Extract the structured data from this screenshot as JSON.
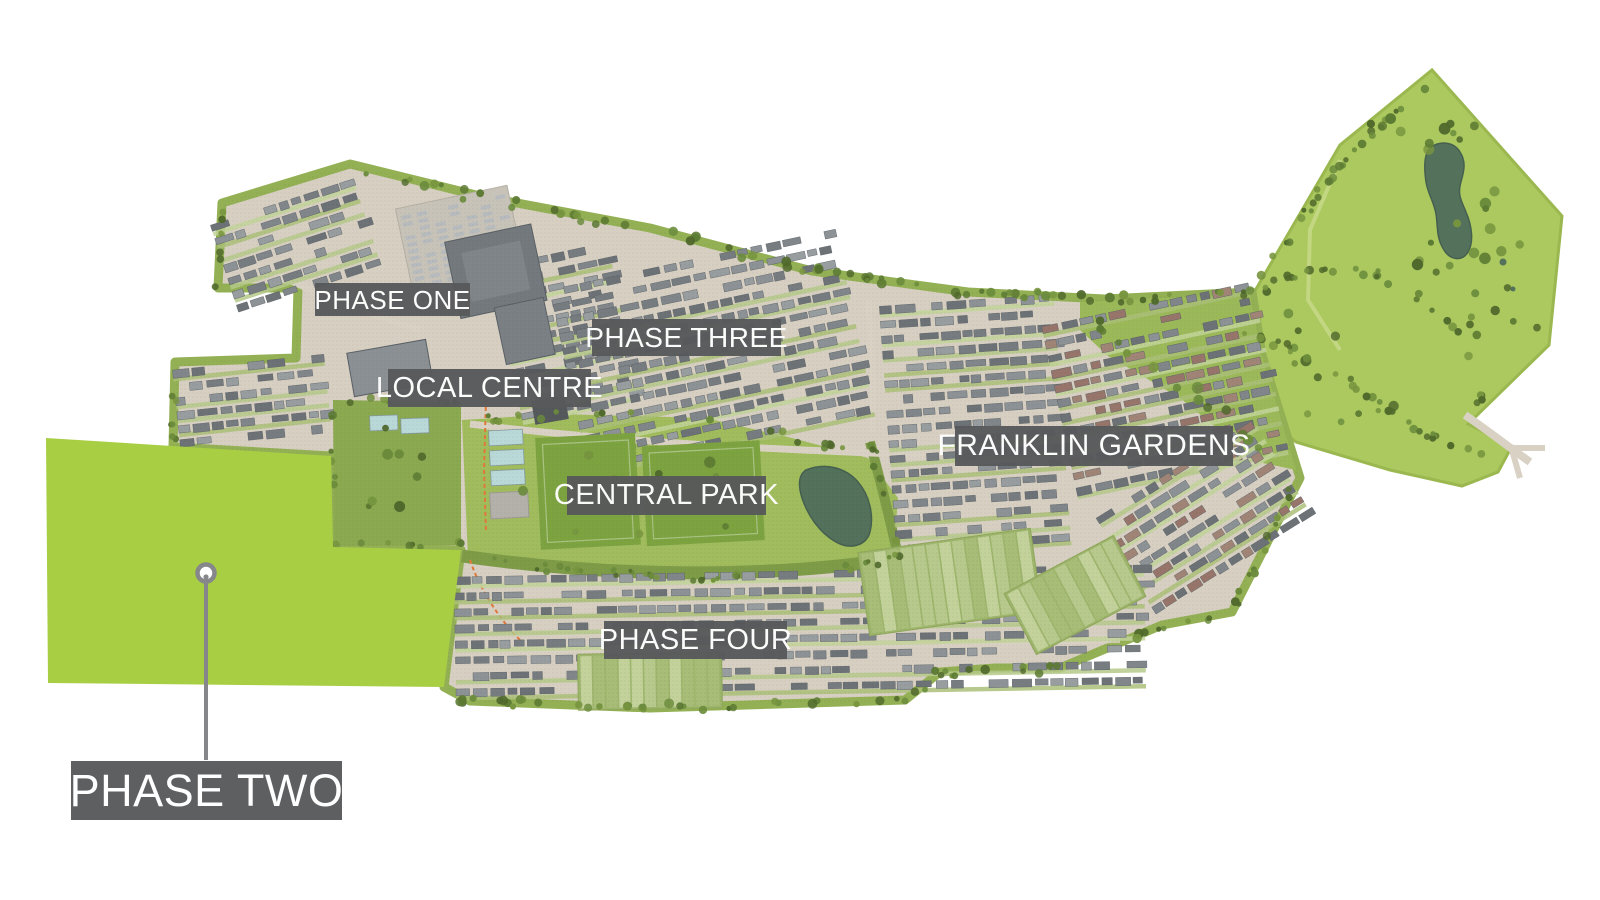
{
  "labels": [
    {
      "id": "phase-one",
      "text": "PHASE ONE"
    },
    {
      "id": "phase-three",
      "text": "PHASE THREE"
    },
    {
      "id": "local-centre",
      "text": "LOCAL CENTRE"
    },
    {
      "id": "central-park",
      "text": "CENTRAL PARK"
    },
    {
      "id": "franklin-gardens",
      "text": "FRANKLIN GARDENS"
    },
    {
      "id": "phase-four",
      "text": "PHASE FOUR"
    },
    {
      "id": "phase-two",
      "text": "PHASE TWO"
    }
  ],
  "pin": {
    "attached_label": "PHASE TWO"
  },
  "colors": {
    "background": "#ffffff",
    "phase_two_fill": "#a8ce44",
    "label_bg": "#58595b",
    "label_text": "#ffffff",
    "pin_color": "#85878a",
    "map_base": "#d6cfc2",
    "belt_green": "#93b054",
    "park_green": "#a0bc5c",
    "dark_park_green": "#8ba950",
    "country_park_green": "#abc95f",
    "pitch_green": "#7da341",
    "court_blue": "#b9d8d8",
    "pond_green": "#54715c",
    "road_beige": "#d9d2c4",
    "path_orange": "#e2793c"
  }
}
